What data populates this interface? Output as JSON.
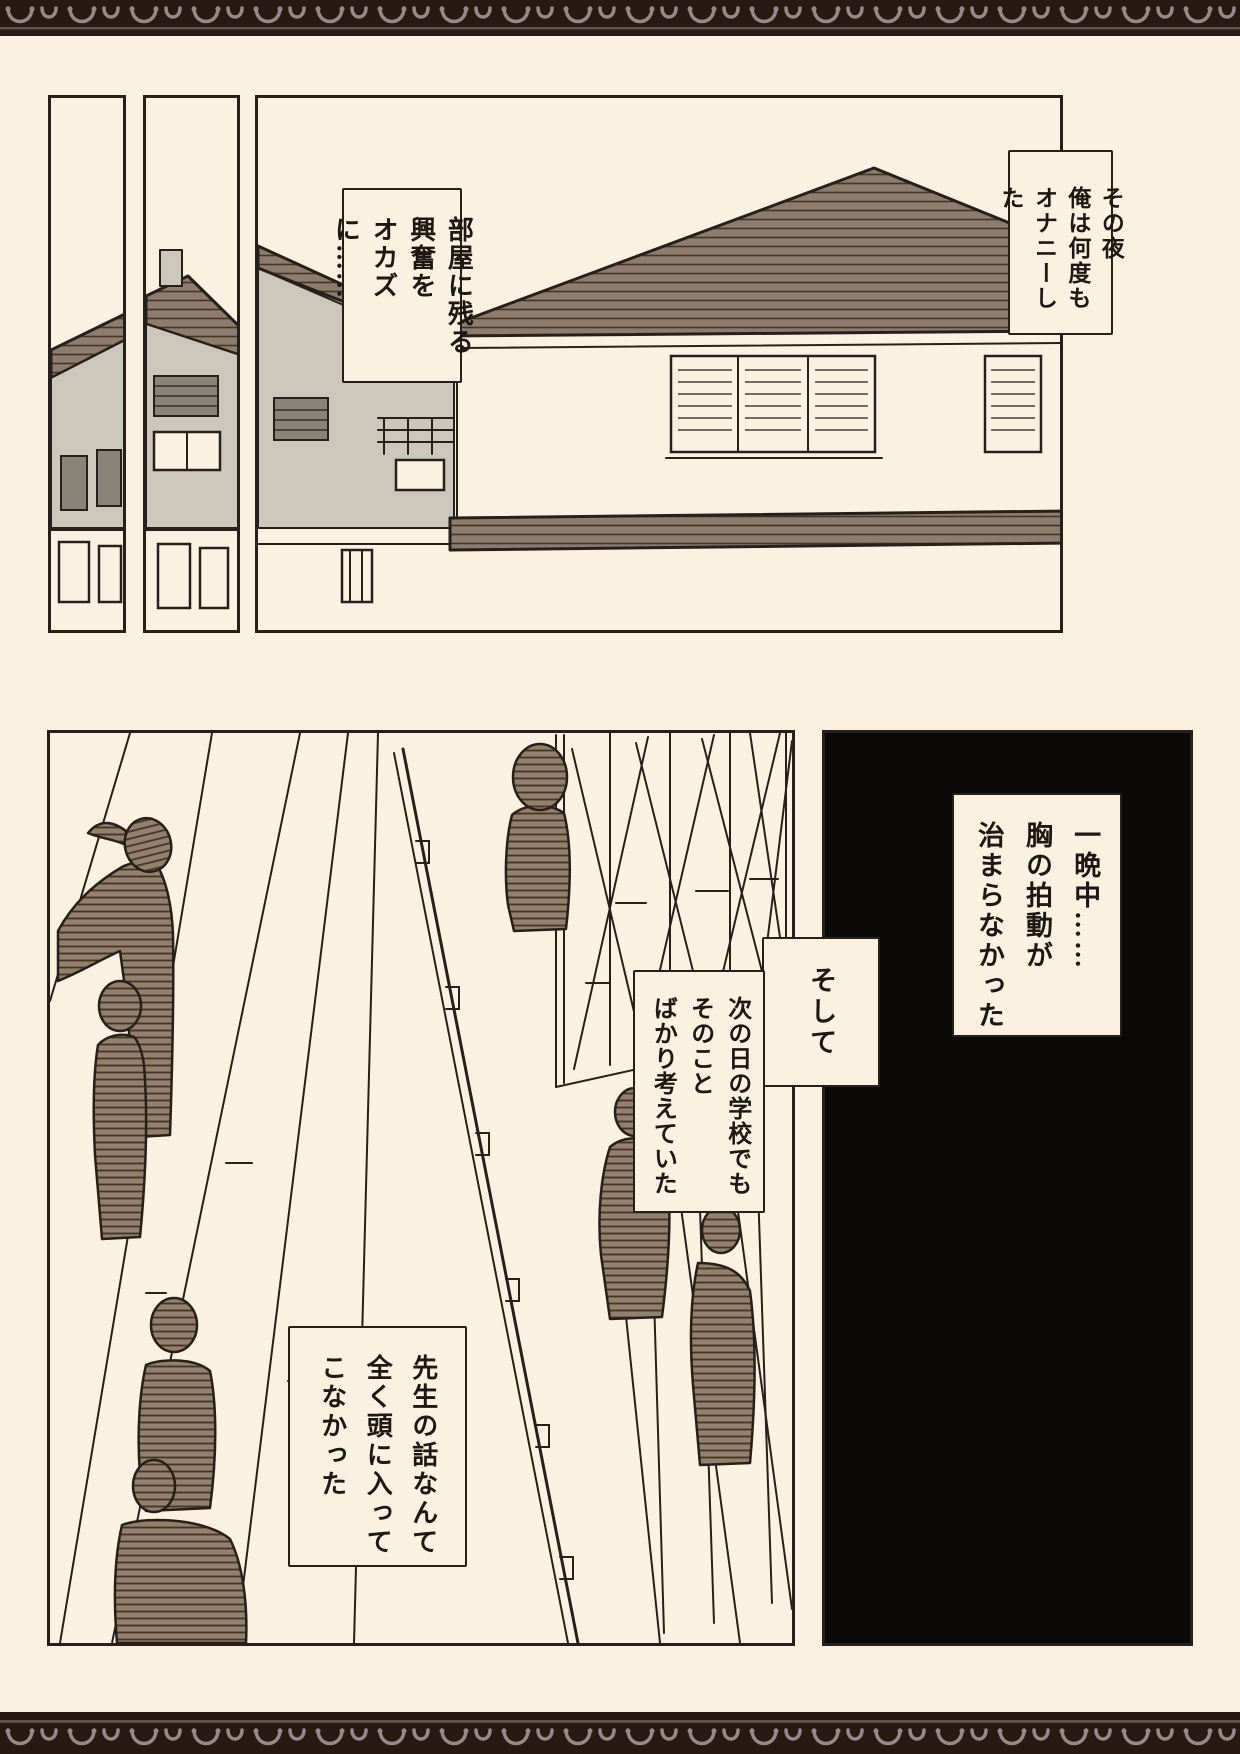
{
  "page": {
    "type": "manga-page",
    "width": 1240,
    "height": 1754
  },
  "colors": {
    "background": "#fbf1e1",
    "ink": "#27201a",
    "text": "#1e1813",
    "panel-black": "#0c0a08",
    "roof-brown": "#8e7c6f",
    "figure-brown": "#93806e",
    "hatch-dark": "#463523",
    "gray-wall": "#ccc6bb",
    "band-brown": "#281913",
    "band-pattern": "#95898a"
  },
  "narration": {
    "night": "その夜\n俺は何度も\nオナニーした",
    "room": "部屋に残る\n興奮を\nオカズに……",
    "allnight": "一晩中……\n胸の拍動が\n治まらなかった",
    "transition": "そして",
    "nextday": "次の日の学校でも\nそのこと\nばかり考えていた",
    "teacher": "先生の話なんて\n全く頭に入って\nこなかった"
  },
  "illustrations": {
    "panel_a": "house-fragment-illustration",
    "panel_b": "neighbor-house-illustration",
    "panel_c": "house-exterior-illustration",
    "school": "school-walkway-students-illustration",
    "blackout": "black-panel"
  }
}
